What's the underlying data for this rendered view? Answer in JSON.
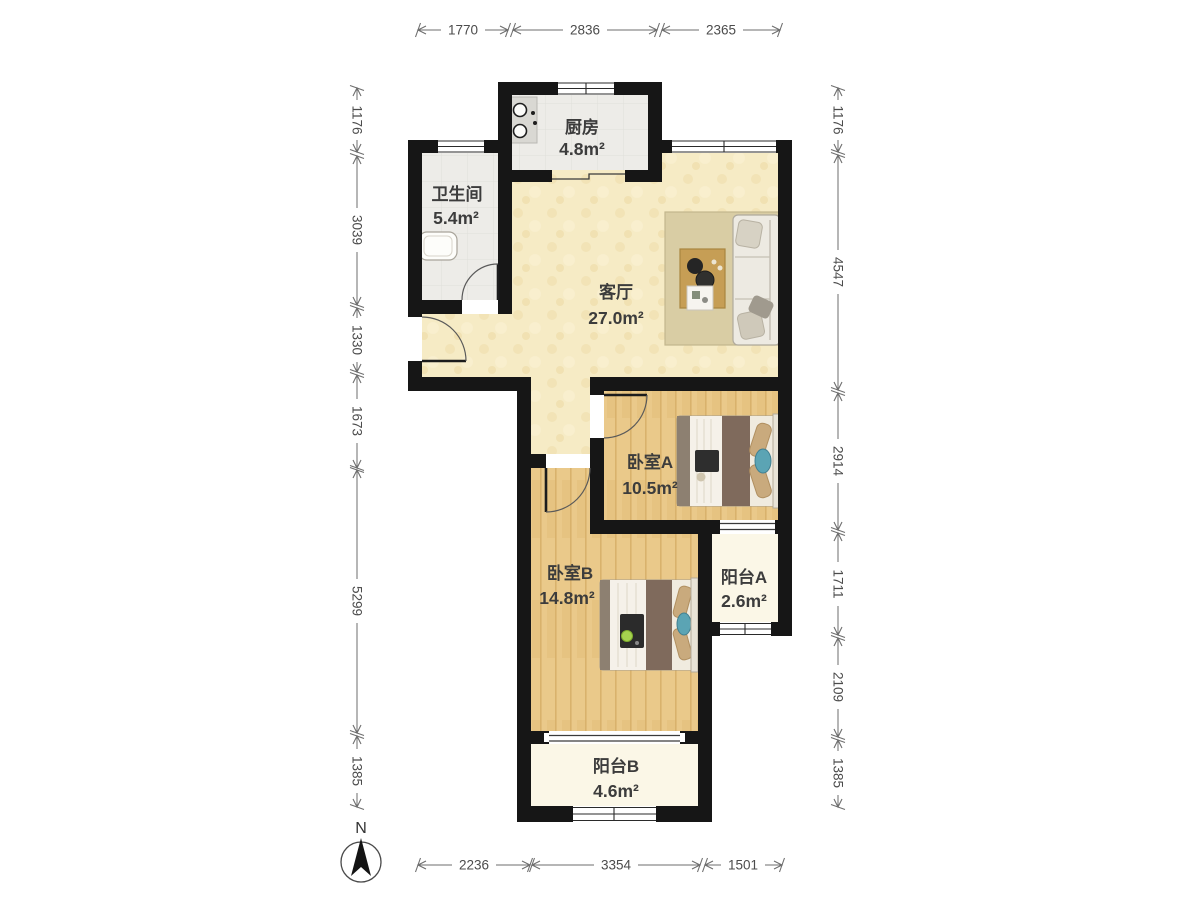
{
  "compass": {
    "north_label": "N"
  },
  "rooms": {
    "kitchen": {
      "name": "厨房",
      "area": "4.8m²"
    },
    "bathroom": {
      "name": "卫生间",
      "area": "5.4m²"
    },
    "living": {
      "name": "客厅",
      "area": "27.0m²"
    },
    "bedroom_a": {
      "name": "卧室A",
      "area": "10.5m²"
    },
    "balcony_a": {
      "name": "阳台A",
      "area": "2.6m²"
    },
    "bedroom_b": {
      "name": "卧室B",
      "area": "14.8m²"
    },
    "balcony_b": {
      "name": "阳台B",
      "area": "4.6m²"
    }
  },
  "dimensions": {
    "top": [
      "1770",
      "2836",
      "2365"
    ],
    "bottom": [
      "2236",
      "3354",
      "1501"
    ],
    "left": [
      "1176",
      "3039",
      "1330",
      "1673",
      "5299",
      "1385"
    ],
    "right": [
      "1176",
      "4547",
      "2914",
      "1711",
      "2109",
      "1385"
    ]
  },
  "colors": {
    "wall": "#161616",
    "living_floor": "#f6ebc5",
    "wood_floor": "#eac98a",
    "balcony_floor": "#fbf7e7",
    "tile_floor": "#edece8",
    "blanket_brown": "#7f6a5c",
    "pillow_tan": "#c9aa7d",
    "accent_teal": "#5ba4b4",
    "table_wood": "#c69e55",
    "dimension_text": "#4c4c4c"
  }
}
